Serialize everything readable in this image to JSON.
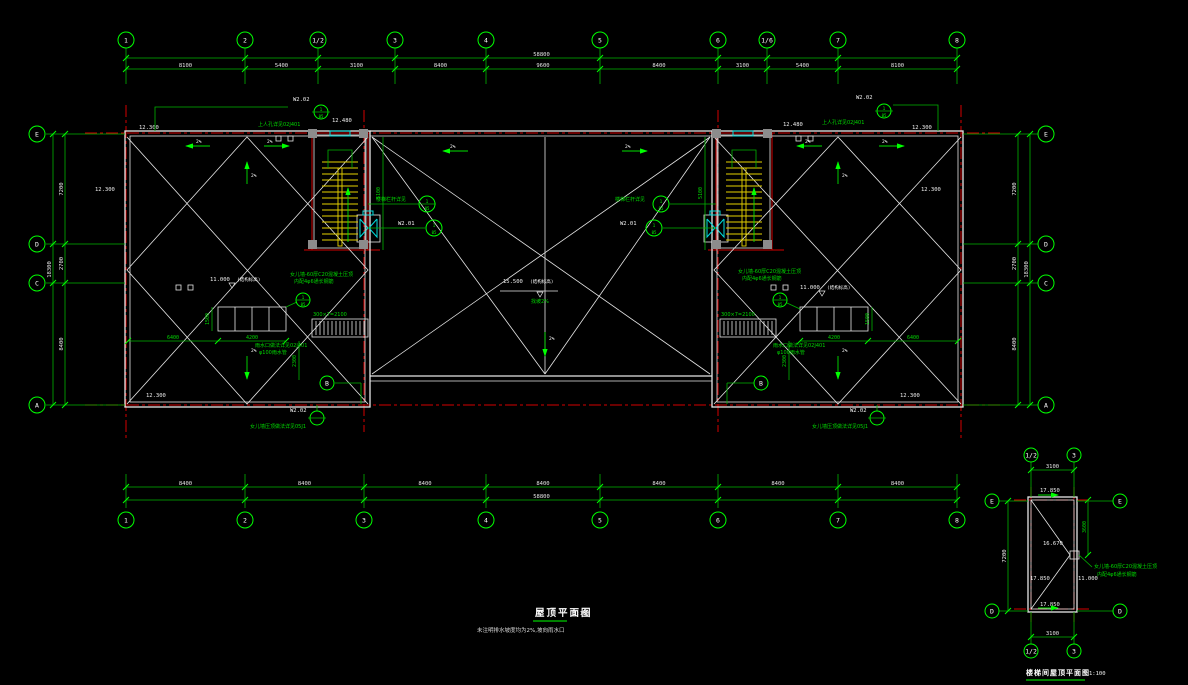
{
  "palette": {
    "green": "#00b400",
    "bright": "#00ff00",
    "white": "#e6e6e6",
    "red": "#d40000",
    "yellow": "#e6d200",
    "cyan": "#00dcdc",
    "gray": "#8c8c8c",
    "bg": "#000000"
  },
  "titles": {
    "main": "屋顶平面图",
    "main_scale": "1:100",
    "note": "未注明排水坡度均为2%,坡向雨水口",
    "sub": "楼梯间屋顶平面图",
    "sub_scale": "1:100"
  },
  "chains": {
    "top": {
      "labels": [
        "1",
        "2",
        "1/2",
        "3",
        "4",
        "5",
        "6",
        "1/6",
        "7",
        "8"
      ],
      "pos": [
        126,
        245,
        318,
        395,
        486,
        600,
        718,
        767,
        838,
        957
      ],
      "dims": [
        "8100",
        "5400",
        "3100",
        "8400",
        "9600",
        "8400",
        "3100",
        "5400",
        "8100"
      ],
      "total": "58800"
    },
    "bottom": {
      "labels": [
        "1",
        "2",
        "3",
        "4",
        "5",
        "6",
        "7",
        "8"
      ],
      "pos": [
        126,
        245,
        364,
        486,
        600,
        718,
        838,
        957
      ],
      "dims": [
        "8400",
        "8400",
        "8400",
        "8400",
        "8400",
        "8400",
        "8400"
      ],
      "total": "58800"
    },
    "left": {
      "labels": [
        "E",
        "D",
        "C",
        "A"
      ],
      "pos": [
        134,
        244,
        283,
        405
      ],
      "dims": [
        "7200",
        "2700",
        "8400"
      ],
      "total": "18300"
    },
    "right": {
      "labels": [
        "E",
        "D",
        "C",
        "A"
      ],
      "pos": [
        134,
        244,
        283,
        405
      ],
      "dims": [
        "7200",
        "2700",
        "8400"
      ],
      "total": "18300"
    },
    "mini_top": {
      "labels": [
        "1/2",
        "3"
      ],
      "pos": [
        1031,
        1074
      ],
      "dims": [
        "3100"
      ],
      "total": null
    },
    "mini_bottom": {
      "labels": [
        "1/2",
        "3"
      ],
      "pos": [
        1031,
        1074
      ],
      "dims": [
        "3100"
      ],
      "total": null
    },
    "mini_left": {
      "labels": [
        "E",
        "D"
      ],
      "pos": [
        501,
        611
      ],
      "dims": [
        "7200"
      ],
      "total": null
    },
    "mini_right": {
      "labels": [
        "E",
        "D"
      ],
      "pos": [
        501,
        611
      ],
      "dims": null,
      "total": null
    }
  },
  "levels": {
    "roof_corner": "12.300",
    "stair_roof": "12.480",
    "center": "15.500",
    "center_note": "(结构标高)",
    "wing": "11.000",
    "wing_note": "(结构标高)",
    "slope": "2%",
    "slope_note": "找坡2%"
  },
  "mini": {
    "lv_top": "17.850",
    "lv_mid": "16.670",
    "lv_low_l": "17.850",
    "lv_low_r": "11.000",
    "lv_bottom": "17.850",
    "dim_right": "3600",
    "note1": "女儿墙-60厚C20混凝土压顶",
    "note2": "内配4φ6通长钢筋"
  },
  "ann": {
    "w202": "W2.02",
    "w201": "W2.01",
    "manhole": "上人孔详见02J401",
    "coping": "女儿墙压顶做法详见05J1",
    "parapet1": "女儿墙-60厚C20混凝土压顶",
    "parapet2": "内配4φ6通长钢筋",
    "drain1": "雨水口做法详见02J401",
    "drain2": "φ100雨水管",
    "rail": "楼梯栏杆详见",
    "ladder": "300×7=2100",
    "det_top": "1",
    "det_bot": "05",
    "b": "B"
  },
  "inner_dims": {
    "d6400": "6400",
    "d4200": "4200",
    "d1500": "1500",
    "d2300": "2300",
    "d5100": "5100"
  }
}
